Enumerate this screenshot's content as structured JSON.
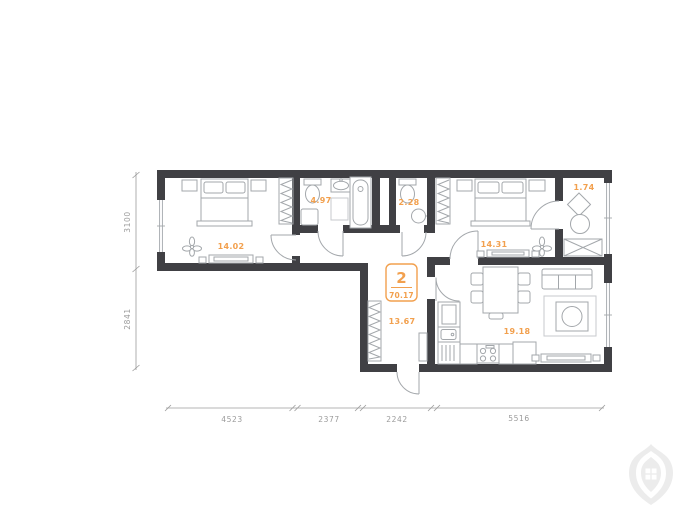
{
  "plan": {
    "badge": {
      "rooms": "2",
      "area": "70.17"
    },
    "rooms": [
      {
        "id": "bedroom-1",
        "area": "14.02"
      },
      {
        "id": "bathroom",
        "area": "4.97"
      },
      {
        "id": "wc",
        "area": "2.28"
      },
      {
        "id": "bedroom-2",
        "area": "14.31"
      },
      {
        "id": "balcony",
        "area": "1.74"
      },
      {
        "id": "hallway",
        "area": "13.67"
      },
      {
        "id": "kitchen-living",
        "area": "19.18"
      }
    ],
    "dimensions": {
      "left": [
        "3100",
        "2841"
      ],
      "bottom": [
        "4523",
        "2377",
        "2242",
        "5516"
      ]
    },
    "colors": {
      "wall": "#404044",
      "furn": "#A3A7AB",
      "soft": "#C7CACD",
      "dim": "#9B9B9B",
      "accent": "#F2A04E",
      "watermark": "#ECECEC"
    }
  }
}
